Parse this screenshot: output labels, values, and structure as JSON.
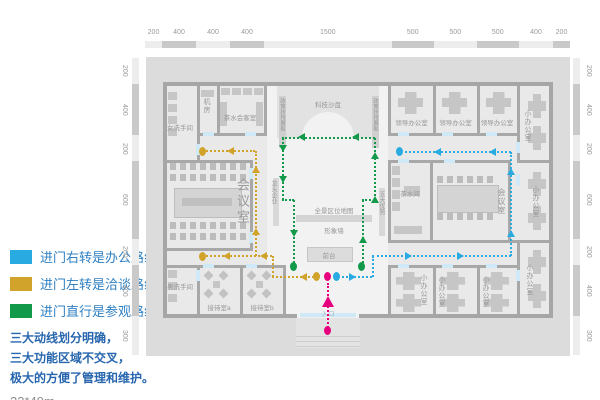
{
  "legend": {
    "items": [
      {
        "color": "#29abe2",
        "label": "进门右转是办公路线"
      },
      {
        "color": "#d2a32a",
        "label": "进门左转是洽谈路线"
      },
      {
        "color": "#12994a",
        "label": "进门直行是参观路线"
      }
    ],
    "notes": [
      "三大动线划分明确，",
      "三大功能区域不交叉，",
      "极大的方便了管理和维护。"
    ],
    "size_label": "23*49m"
  },
  "plan": {
    "rulers": {
      "top": [
        "200",
        "400",
        "400",
        "400",
        "1500",
        "500",
        "500",
        "500",
        "400",
        "200"
      ],
      "left": [
        "200",
        "400",
        "200",
        "600",
        "200",
        "400",
        "300"
      ],
      "right": [
        "200",
        "400",
        "200",
        "600",
        "200",
        "400",
        "300"
      ]
    },
    "rooms": {
      "women_wc": "女洗手间",
      "machine_room": "机房",
      "tea_reception": "茶水会客室",
      "tech_sandbox": "科技沙盘",
      "policy_board": "政策扶持展板",
      "leader_office": "领导办公室",
      "small_office": "小办公室",
      "meeting_room": "会议室",
      "leading_enterprises": "龙头企业",
      "five_advantages": "五大优势",
      "panorama_map": "全景区位地图",
      "image_wall": "形象墙",
      "front_desk": "前台",
      "tea_room": "茶水间",
      "men_wc": "男洗手间",
      "reception_a": "接待室a",
      "reception_b": "接待室b",
      "entrance": "入口"
    },
    "routes": {
      "office_color": "#29abe2",
      "negotiation_color": "#d2a32a",
      "visit_color": "#12994a",
      "entrance_color": "#e6007e"
    }
  }
}
